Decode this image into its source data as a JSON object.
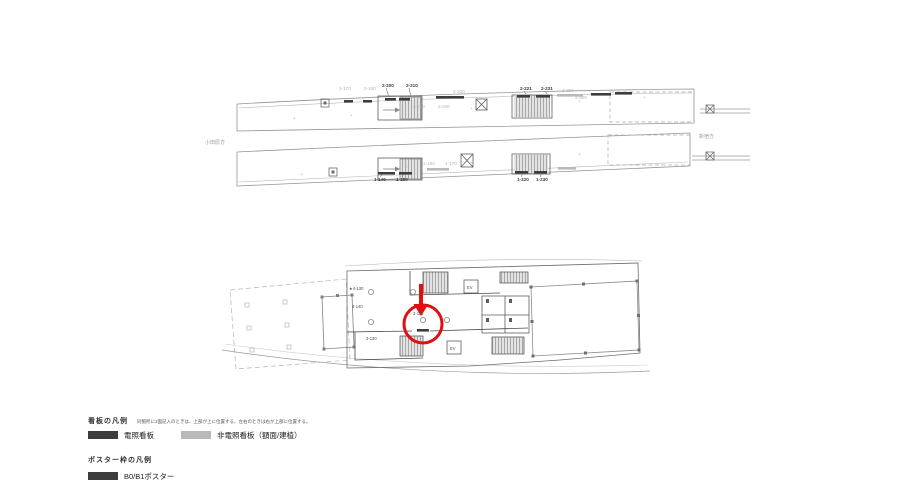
{
  "colors": {
    "red": "#e01010",
    "sign_dark": "#3d3d3d",
    "sign_grey": "#b9b9b9",
    "line_grey": "#9a9a9a",
    "wall_dark": "#4a4a4a"
  },
  "legend": {
    "signs_title": "看板の凡例",
    "signs_note": "同箇所に2面記入のときは、上部が上に位置する。左右のときは右が上部に位置する。",
    "items": [
      {
        "label": "電照看板",
        "swatch": "dark"
      },
      {
        "label": "非電照看板（額面/建植）",
        "swatch": "grey"
      }
    ],
    "poster_title": "ポスター枠の凡例",
    "poster_items": [
      {
        "label": "B0/B1ポスター",
        "swatch": "dark"
      }
    ]
  },
  "drawing": {
    "labels": [
      {
        "t": "2-170",
        "x": 339,
        "y": 90,
        "k": "g"
      },
      {
        "t": "2-180",
        "x": 364,
        "y": 90,
        "k": "g"
      },
      {
        "t": "2-200",
        "x": 382,
        "y": 87,
        "k": "d"
      },
      {
        "t": "2-210",
        "x": 406,
        "y": 87,
        "k": "d"
      },
      {
        "t": "2-230",
        "x": 453,
        "y": 93,
        "k": "g"
      },
      {
        "t": "2-220",
        "x": 413,
        "y": 108,
        "k": "g"
      },
      {
        "t": "2-240",
        "x": 438,
        "y": 108,
        "k": "g"
      },
      {
        "t": "2-221",
        "x": 520,
        "y": 90,
        "k": "d"
      },
      {
        "t": "2-231",
        "x": 541,
        "y": 90,
        "k": "d"
      },
      {
        "t": "2-260",
        "x": 562,
        "y": 92,
        "k": "g"
      },
      {
        "t": "2-300",
        "x": 575,
        "y": 99,
        "k": "g"
      },
      {
        "t": "1-160",
        "x": 423,
        "y": 165,
        "k": "g"
      },
      {
        "t": "1-170",
        "x": 445,
        "y": 165,
        "k": "g"
      },
      {
        "t": "1-140",
        "x": 374,
        "y": 181,
        "k": "d"
      },
      {
        "t": "1-150",
        "x": 396,
        "y": 181,
        "k": "d"
      },
      {
        "t": "1-220",
        "x": 517,
        "y": 181,
        "k": "d"
      },
      {
        "t": "1-230",
        "x": 536,
        "y": 181,
        "k": "d"
      },
      {
        "t": "小田原方",
        "x": 205,
        "y": 144,
        "k": "g2"
      },
      {
        "t": "新宿方",
        "x": 699,
        "y": 138,
        "k": "g2"
      },
      {
        "t": "★4-130",
        "x": 349,
        "y": 290,
        "k": "t"
      },
      {
        "t": "4-140",
        "x": 352,
        "y": 308,
        "k": "t"
      },
      {
        "t": "3-130",
        "x": 366,
        "y": 340,
        "k": "t"
      },
      {
        "t": "3-110",
        "x": 413,
        "y": 315,
        "k": "t"
      },
      {
        "t": "EV",
        "x": 467,
        "y": 289,
        "k": "t"
      },
      {
        "t": "EV",
        "x": 450,
        "y": 350,
        "k": "t"
      },
      {
        "t": "+",
        "x": 293,
        "y": 120,
        "k": "g"
      },
      {
        "t": "+",
        "x": 350,
        "y": 117,
        "k": "g"
      },
      {
        "t": "+",
        "x": 470,
        "y": 110,
        "k": "g"
      },
      {
        "t": "+",
        "x": 578,
        "y": 103,
        "k": "g"
      },
      {
        "t": "+",
        "x": 643,
        "y": 99,
        "k": "g"
      },
      {
        "t": "+",
        "x": 300,
        "y": 176,
        "k": "g"
      },
      {
        "t": "+",
        "x": 405,
        "y": 168,
        "k": "g"
      },
      {
        "t": "+",
        "x": 470,
        "y": 164,
        "k": "g"
      },
      {
        "t": "+",
        "x": 578,
        "y": 156,
        "k": "g"
      }
    ],
    "sign_bars": [
      {
        "x": 344,
        "y": 100,
        "w": 9,
        "f": "d"
      },
      {
        "x": 363,
        "y": 100,
        "w": 9,
        "f": "d"
      },
      {
        "x": 385,
        "y": 98,
        "w": 11,
        "f": "d"
      },
      {
        "x": 399,
        "y": 98,
        "w": 11,
        "f": "d"
      },
      {
        "x": 436,
        "y": 96,
        "w": 28,
        "f": "d"
      },
      {
        "x": 517,
        "y": 95,
        "w": 13,
        "f": "d"
      },
      {
        "x": 536,
        "y": 95,
        "w": 14,
        "f": "d"
      },
      {
        "x": 557,
        "y": 94,
        "w": 26,
        "f": "g"
      },
      {
        "x": 591,
        "y": 93,
        "w": 20,
        "f": "d"
      },
      {
        "x": 615,
        "y": 92,
        "w": 17,
        "f": "d"
      },
      {
        "x": 378,
        "y": 172,
        "w": 17,
        "f": "d"
      },
      {
        "x": 399,
        "y": 172,
        "w": 13,
        "f": "d"
      },
      {
        "x": 427,
        "y": 168,
        "w": 22,
        "f": "g"
      },
      {
        "x": 515,
        "y": 171,
        "w": 13,
        "f": "d"
      },
      {
        "x": 534,
        "y": 171,
        "w": 13,
        "f": "d"
      },
      {
        "x": 558,
        "y": 167,
        "w": 18,
        "f": "g"
      },
      {
        "x": 417,
        "y": 329,
        "w": 12,
        "f": "d"
      }
    ]
  }
}
